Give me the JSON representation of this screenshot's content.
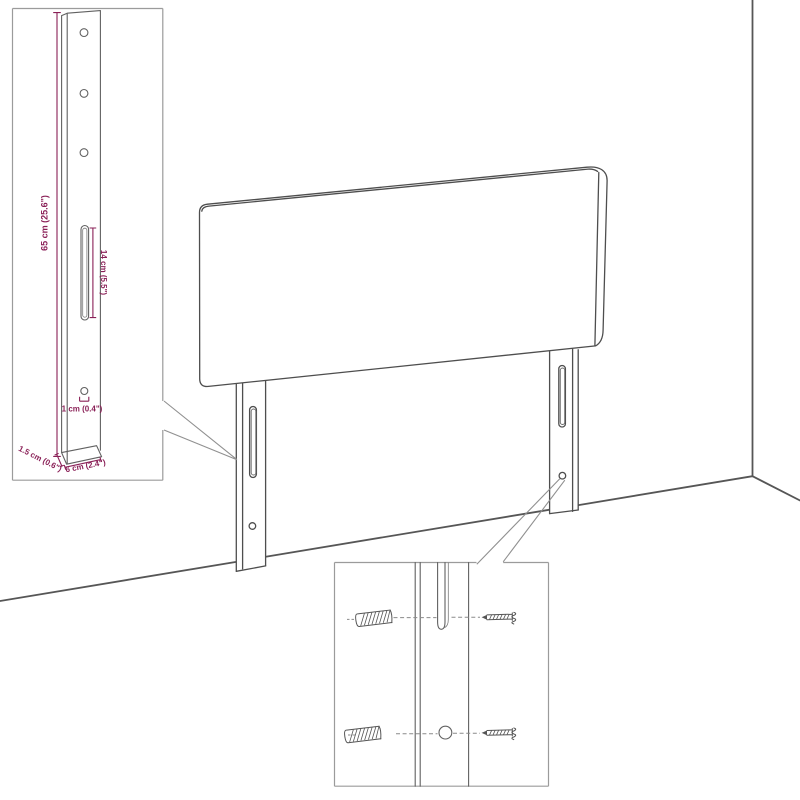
{
  "image_type": "furniture-assembly-dimension-diagram",
  "subject": "headboard-with-wall-mount-legs",
  "colors": {
    "background": "#ffffff",
    "drawing_line": "#4e4e4e",
    "wall_line": "#565656",
    "inset_border": "#9b9b9b",
    "dimension_accent": "#8a2057"
  },
  "dimensions": {
    "height": "65 cm (25.6\")",
    "slot_length": "14 cm (5.5\")",
    "hole_diameter": "1 cm (0.4\")",
    "thickness": "1.5 cm (0.6\")",
    "width": "6 cm (2.4\")"
  }
}
